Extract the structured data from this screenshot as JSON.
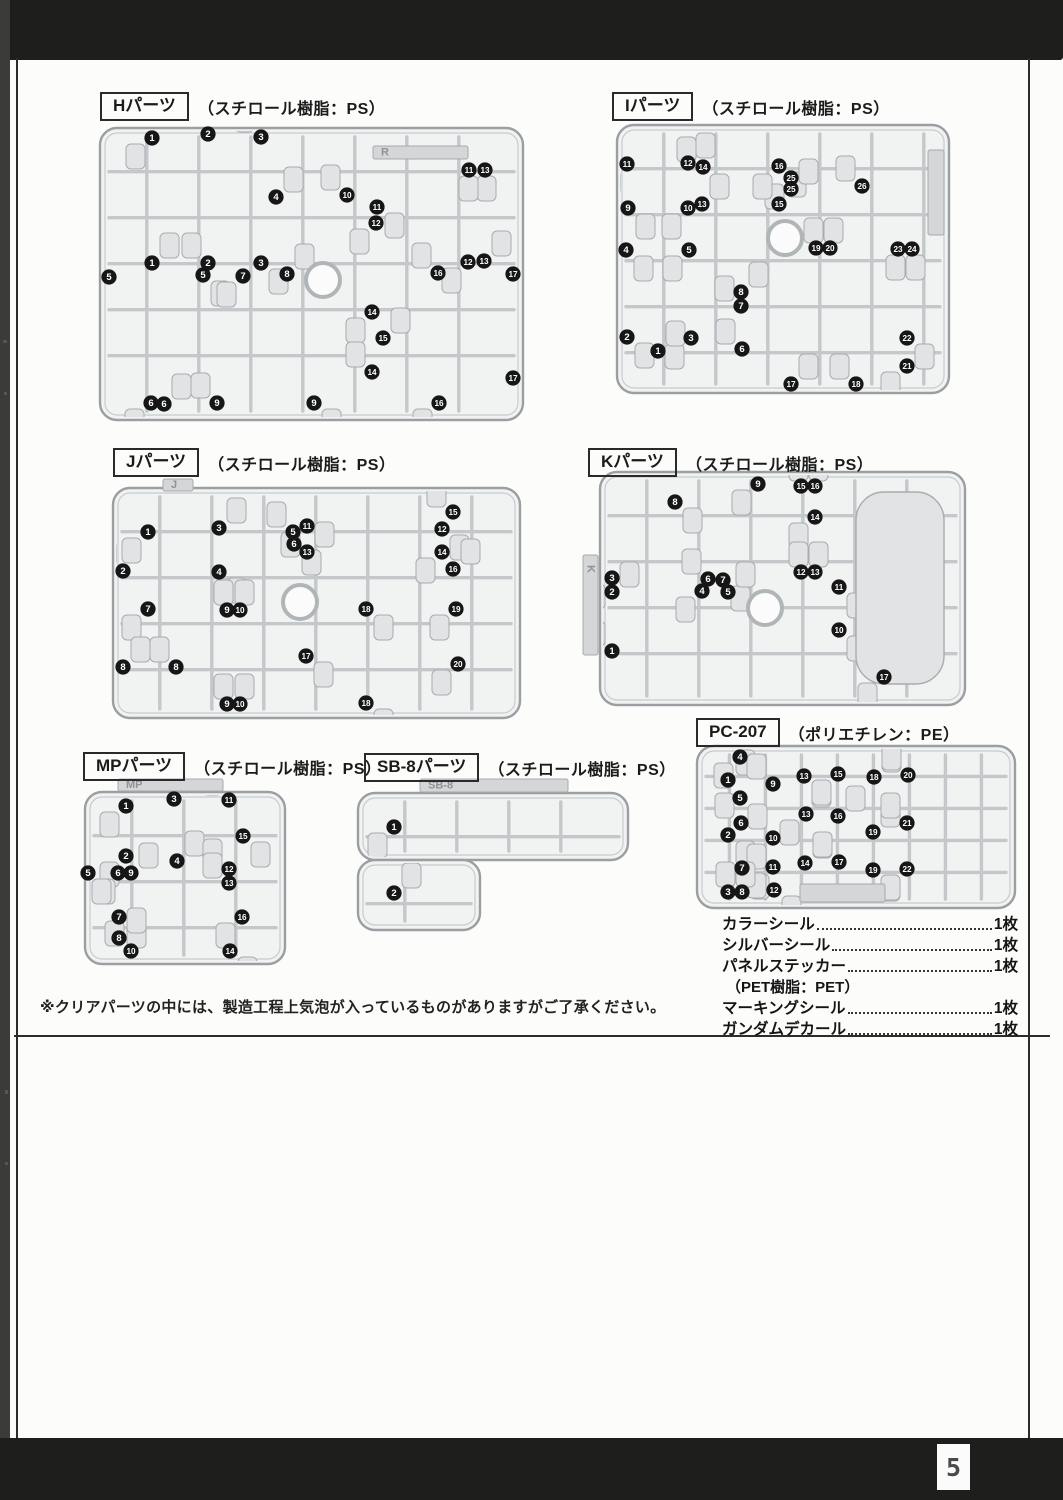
{
  "page": {
    "number": "5"
  },
  "note": "※クリアパーツの中には、製造工程上気泡が入っているものがありますがご了承ください。",
  "accessories": {
    "items": [
      {
        "name": "カラーシール",
        "count": "1枚"
      },
      {
        "name": "シルバーシール",
        "count": "1枚"
      },
      {
        "name": "パネルステッカー",
        "count": "1枚"
      },
      {
        "name": "（PET樹脂：PET）",
        "count": ""
      },
      {
        "name": "マーキングシール",
        "count": "1枚"
      },
      {
        "name": "ガンダムデカール",
        "count": "1枚"
      }
    ]
  },
  "runners": [
    {
      "id": "H",
      "label": "Hパーツ",
      "material": "（スチロール樹脂：PS）",
      "label_x": 100,
      "label_y": 92,
      "frame": {
        "x": 100,
        "y": 128,
        "w": 423,
        "h": 292
      },
      "circle": {
        "cx": 323,
        "cy": 280,
        "r": 17
      },
      "plate": {
        "x": 373,
        "y": 146,
        "w": 95,
        "h": 13,
        "text": "R",
        "vertical": false
      },
      "badges": [
        [
          1,
          152,
          138
        ],
        [
          2,
          208,
          134
        ],
        [
          3,
          261,
          137
        ],
        [
          11,
          469,
          170
        ],
        [
          13,
          485,
          170
        ],
        [
          4,
          276,
          197
        ],
        [
          10,
          347,
          195
        ],
        [
          11,
          377,
          207
        ],
        [
          12,
          376,
          223
        ],
        [
          1,
          152,
          263
        ],
        [
          2,
          208,
          263
        ],
        [
          3,
          261,
          263
        ],
        [
          12,
          468,
          262
        ],
        [
          13,
          484,
          261
        ],
        [
          5,
          109,
          277
        ],
        [
          5,
          203,
          275
        ],
        [
          7,
          243,
          276
        ],
        [
          8,
          287,
          274
        ],
        [
          16,
          438,
          273
        ],
        [
          17,
          513,
          274
        ],
        [
          14,
          372,
          312
        ],
        [
          15,
          383,
          338
        ],
        [
          14,
          372,
          372
        ],
        [
          17,
          513,
          378
        ],
        [
          6,
          151,
          403
        ],
        [
          6,
          164,
          404
        ],
        [
          9,
          217,
          403
        ],
        [
          9,
          314,
          403
        ],
        [
          16,
          439,
          403
        ]
      ]
    },
    {
      "id": "I",
      "label": "Iパーツ",
      "material": "（スチロール樹脂：PS）",
      "label_x": 612,
      "label_y": 92,
      "frame": {
        "x": 617,
        "y": 125,
        "w": 332,
        "h": 268
      },
      "circle": {
        "cx": 785,
        "cy": 238,
        "r": 17
      },
      "plate": {
        "x": 928,
        "y": 150,
        "w": 16,
        "h": 85,
        "text": "",
        "vertical": true
      },
      "badges": [
        [
          11,
          627,
          164
        ],
        [
          12,
          688,
          163
        ],
        [
          14,
          703,
          167
        ],
        [
          16,
          779,
          166
        ],
        [
          25,
          791,
          178
        ],
        [
          25,
          791,
          189
        ],
        [
          26,
          862,
          186
        ],
        [
          9,
          628,
          208
        ],
        [
          10,
          688,
          208
        ],
        [
          13,
          702,
          204
        ],
        [
          15,
          779,
          204
        ],
        [
          4,
          626,
          250
        ],
        [
          5,
          689,
          250
        ],
        [
          19,
          816,
          248
        ],
        [
          20,
          830,
          248
        ],
        [
          23,
          898,
          249
        ],
        [
          24,
          912,
          249
        ],
        [
          8,
          741,
          292
        ],
        [
          7,
          741,
          306
        ],
        [
          2,
          627,
          337
        ],
        [
          3,
          691,
          338
        ],
        [
          1,
          658,
          351
        ],
        [
          6,
          742,
          349
        ],
        [
          22,
          907,
          338
        ],
        [
          21,
          907,
          366
        ],
        [
          17,
          791,
          384
        ],
        [
          18,
          856,
          384
        ]
      ]
    },
    {
      "id": "J",
      "label": "Jパーツ",
      "material": "（スチロール樹脂：PS）",
      "label_x": 113,
      "label_y": 448,
      "frame": {
        "x": 113,
        "y": 488,
        "w": 407,
        "h": 230
      },
      "circle": {
        "cx": 300,
        "cy": 602,
        "r": 17
      },
      "plate": {
        "x": 163,
        "y": 479,
        "w": 30,
        "h": 12,
        "text": "J",
        "vertical": false
      },
      "badges": [
        [
          1,
          148,
          532
        ],
        [
          3,
          219,
          528
        ],
        [
          5,
          293,
          532
        ],
        [
          6,
          294,
          544
        ],
        [
          11,
          307,
          526
        ],
        [
          13,
          307,
          552
        ],
        [
          15,
          453,
          512
        ],
        [
          12,
          442,
          529
        ],
        [
          14,
          442,
          552
        ],
        [
          16,
          453,
          569
        ],
        [
          2,
          123,
          571
        ],
        [
          4,
          219,
          572
        ],
        [
          7,
          148,
          609
        ],
        [
          9,
          227,
          610
        ],
        [
          10,
          240,
          610
        ],
        [
          18,
          366,
          609
        ],
        [
          19,
          456,
          609
        ],
        [
          8,
          123,
          667
        ],
        [
          8,
          176,
          667
        ],
        [
          17,
          306,
          656
        ],
        [
          20,
          458,
          664
        ],
        [
          9,
          227,
          704
        ],
        [
          10,
          240,
          704
        ],
        [
          18,
          366,
          703
        ]
      ]
    },
    {
      "id": "K",
      "label": "Kパーツ",
      "material": "（スチロール樹脂：PS）",
      "label_x": 588,
      "label_y": 448,
      "frame": {
        "x": 600,
        "y": 472,
        "w": 365,
        "h": 233
      },
      "circle": {
        "cx": 765,
        "cy": 608,
        "r": 17
      },
      "plate": {
        "x": 583,
        "y": 555,
        "w": 15,
        "h": 100,
        "text": "K",
        "vertical": true
      },
      "bigparts": [
        {
          "x": 856,
          "y": 492,
          "w": 88,
          "h": 192
        }
      ],
      "badges": [
        [
          9,
          758,
          484
        ],
        [
          15,
          801,
          486
        ],
        [
          16,
          815,
          486
        ],
        [
          8,
          675,
          502
        ],
        [
          14,
          815,
          517
        ],
        [
          12,
          801,
          572
        ],
        [
          13,
          815,
          572
        ],
        [
          11,
          839,
          587
        ],
        [
          3,
          612,
          578
        ],
        [
          2,
          612,
          592
        ],
        [
          6,
          708,
          579
        ],
        [
          7,
          723,
          580
        ],
        [
          4,
          702,
          591
        ],
        [
          5,
          728,
          592
        ],
        [
          1,
          612,
          651
        ],
        [
          10,
          839,
          630
        ],
        [
          17,
          884,
          677
        ]
      ]
    },
    {
      "id": "MP",
      "label": "MPパーツ",
      "material": "（スチロール樹脂：PS）",
      "label_x": 83,
      "label_y": 752,
      "frame": {
        "x": 85,
        "y": 792,
        "w": 200,
        "h": 172
      },
      "circle": null,
      "plate": {
        "x": 118,
        "y": 779,
        "w": 105,
        "h": 12,
        "text": "MP",
        "vertical": false
      },
      "badges": [
        [
          1,
          126,
          806
        ],
        [
          3,
          174,
          799
        ],
        [
          11,
          229,
          800
        ],
        [
          15,
          243,
          836
        ],
        [
          2,
          126,
          856
        ],
        [
          4,
          177,
          861
        ],
        [
          12,
          229,
          869
        ],
        [
          5,
          88,
          873
        ],
        [
          6,
          118,
          873
        ],
        [
          9,
          131,
          873
        ],
        [
          13,
          229,
          883
        ],
        [
          7,
          119,
          917
        ],
        [
          16,
          242,
          917
        ],
        [
          8,
          119,
          938
        ],
        [
          10,
          131,
          951
        ],
        [
          14,
          230,
          951
        ]
      ]
    },
    {
      "id": "SB-8",
      "label": "SB-8パーツ",
      "material": "（スチロール樹脂：PS）",
      "label_x": 364,
      "label_y": 753,
      "frame": {
        "x": 358,
        "y": 793,
        "w": 270,
        "h": 67
      },
      "frame2": {
        "x": 358,
        "y": 860,
        "w": 122,
        "h": 70
      },
      "circle": null,
      "plate": {
        "x": 420,
        "y": 779,
        "w": 148,
        "h": 13,
        "text": "SB-8",
        "vertical": false
      },
      "badges": [
        [
          1,
          394,
          827
        ],
        [
          2,
          394,
          893
        ]
      ]
    },
    {
      "id": "PC-207",
      "label": "PC-207",
      "material": "（ポリエチレン：PE）",
      "label_x": 696,
      "label_y": 718,
      "frame": {
        "x": 697,
        "y": 746,
        "w": 318,
        "h": 162
      },
      "circle": null,
      "plate": {
        "x": 800,
        "y": 884,
        "w": 85,
        "h": 18,
        "text": "",
        "vertical": false
      },
      "lattice": [
        36,
        32
      ],
      "badges": [
        [
          4,
          740,
          757
        ],
        [
          1,
          728,
          780
        ],
        [
          9,
          773,
          784
        ],
        [
          13,
          804,
          776
        ],
        [
          15,
          838,
          774
        ],
        [
          18,
          874,
          777
        ],
        [
          20,
          908,
          775
        ],
        [
          5,
          740,
          798
        ],
        [
          13,
          806,
          814
        ],
        [
          16,
          838,
          816
        ],
        [
          6,
          741,
          823
        ],
        [
          2,
          728,
          835
        ],
        [
          10,
          773,
          838
        ],
        [
          19,
          873,
          832
        ],
        [
          21,
          907,
          823
        ],
        [
          7,
          742,
          868
        ],
        [
          11,
          773,
          867
        ],
        [
          14,
          805,
          863
        ],
        [
          17,
          839,
          862
        ],
        [
          19,
          873,
          870
        ],
        [
          22,
          907,
          869
        ],
        [
          3,
          728,
          892
        ],
        [
          8,
          742,
          892
        ],
        [
          12,
          774,
          890
        ]
      ]
    }
  ]
}
